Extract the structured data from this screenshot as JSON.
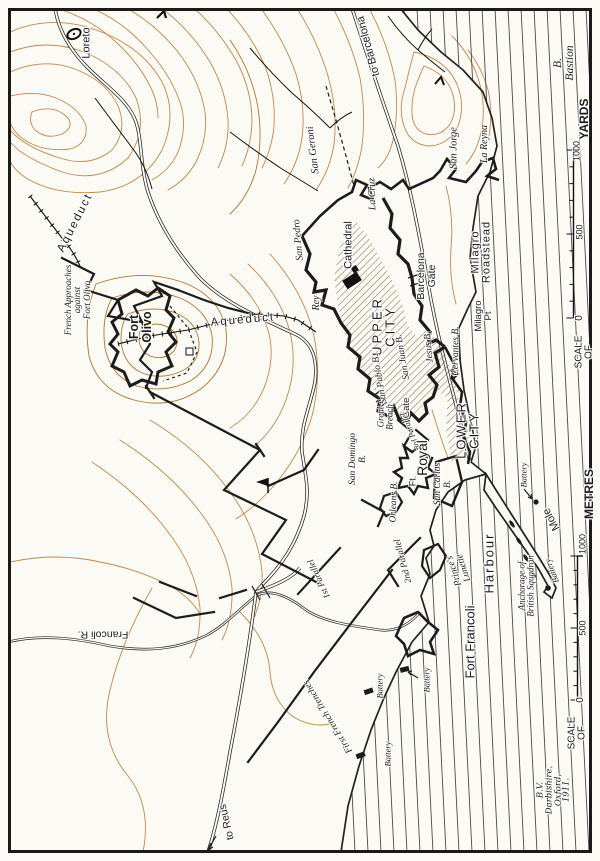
{
  "colors": {
    "paper": "#fcfaf4",
    "ink": "#1c1c1c",
    "contour": "#c4874a",
    "contour2": "#b2762f",
    "hatch": "#85704e",
    "sealine": "#4a4a4a"
  },
  "map": {
    "description_labels": "Siege map lettering (map is rotated; most text reads bottom-to-top)",
    "labels": [
      {
        "n": "loreto",
        "t": "Loreto",
        "x": 87,
        "y": 43,
        "r": -90,
        "s": 11,
        "c": "sans"
      },
      {
        "n": "to-barcelona",
        "t": "to Barcelona",
        "x": 369,
        "y": 46,
        "r": -105,
        "s": 11,
        "c": "sans"
      },
      {
        "n": "b-bastion-legend",
        "t": "B.  Bastion",
        "x": 565,
        "y": 63,
        "r": -90,
        "s": 11.5,
        "c": "it"
      },
      {
        "n": "yards-label",
        "t": "YARDS",
        "x": 584,
        "y": 119,
        "r": -90,
        "s": 12,
        "c": "sans",
        "w": 700
      },
      {
        "n": "yards-1000",
        "t": "1000",
        "x": 577,
        "y": 151,
        "r": -90,
        "s": 9,
        "c": "sans"
      },
      {
        "n": "yards-500",
        "t": "500",
        "x": 580,
        "y": 232,
        "r": -90,
        "s": 9,
        "c": "sans"
      },
      {
        "n": "yards-0",
        "t": "0",
        "x": 580,
        "y": 318,
        "r": -90,
        "s": 10,
        "c": "sans"
      },
      {
        "n": "yards-scale-of",
        "t": "SCALE OF",
        "x": 585,
        "y": 352,
        "r": -90,
        "s": 10,
        "c": "sans"
      },
      {
        "n": "metres-label",
        "t": "METRES",
        "x": 589,
        "y": 494,
        "r": -90,
        "s": 12,
        "c": "sans",
        "w": 700
      },
      {
        "n": "metres-1000",
        "t": "1000",
        "x": 583,
        "y": 544,
        "r": -90,
        "s": 9,
        "c": "sans"
      },
      {
        "n": "metres-500",
        "t": "500",
        "x": 583,
        "y": 628,
        "r": -90,
        "s": 9,
        "c": "sans"
      },
      {
        "n": "metres-0",
        "t": "0",
        "x": 581,
        "y": 700,
        "r": -90,
        "s": 10,
        "c": "sans"
      },
      {
        "n": "metres-scale-of",
        "t": "SCALE OF",
        "x": 578,
        "y": 733,
        "r": -90,
        "s": 10,
        "c": "sans"
      },
      {
        "n": "signature",
        "t": "B.V. Darbishire, Oxford, 1911.",
        "x": 554,
        "y": 790,
        "r": -90,
        "s": 8.5,
        "c": "scr"
      },
      {
        "n": "san-geroni",
        "t": "San Geroni",
        "x": 314,
        "y": 150,
        "r": -97,
        "s": 10.5,
        "c": "it"
      },
      {
        "n": "la-cruz",
        "t": "La Cruz",
        "x": 373,
        "y": 194,
        "r": -92,
        "s": 10,
        "c": "it"
      },
      {
        "n": "san-pedro",
        "t": "San Pedro",
        "x": 299,
        "y": 240,
        "r": -95,
        "s": 10,
        "c": "it"
      },
      {
        "n": "rey",
        "t": "Rey",
        "x": 317,
        "y": 303,
        "r": -90,
        "s": 10,
        "c": "it"
      },
      {
        "n": "cathedral",
        "t": "Cathedral",
        "x": 349,
        "y": 245,
        "r": -90,
        "s": 11,
        "c": "sans"
      },
      {
        "n": "san-jorge",
        "t": "San Jorge",
        "x": 455,
        "y": 148,
        "r": -90,
        "s": 10.5,
        "c": "it"
      },
      {
        "n": "la-reyna",
        "t": "La Reyna",
        "x": 485,
        "y": 144,
        "r": -90,
        "s": 10,
        "c": "it"
      },
      {
        "n": "upper-city",
        "t": "UPPER\nCITY",
        "x": 384,
        "y": 326,
        "r": -90,
        "s": 13,
        "c": "sans",
        "sp": 3
      },
      {
        "n": "barcelona-gate",
        "t": "Barcelona\nGate",
        "x": 427,
        "y": 276,
        "r": -90,
        "s": 10.5,
        "c": "sans"
      },
      {
        "n": "milagro-roadstead",
        "t": "Milagro\nRoadstead",
        "x": 482,
        "y": 252,
        "r": -90,
        "s": 11,
        "c": "sans",
        "sp": 1
      },
      {
        "n": "milagro-pt",
        "t": "Milagro\nPt",
        "x": 484,
        "y": 316,
        "r": -90,
        "s": 9.5,
        "c": "sans"
      },
      {
        "n": "cervantes-b",
        "t": "Cervantes B.",
        "x": 457,
        "y": 351,
        "r": -90,
        "s": 9.5,
        "c": "it"
      },
      {
        "n": "jesus-b",
        "t": "Jesus B.",
        "x": 430,
        "y": 347,
        "r": -96,
        "s": 9.5,
        "c": "it"
      },
      {
        "n": "san-juan-b",
        "t": "San Juan B.",
        "x": 404,
        "y": 357,
        "r": -100,
        "s": 9.5,
        "c": "it"
      },
      {
        "n": "san-pablo-b",
        "t": "San Pablo B.",
        "x": 381,
        "y": 379,
        "r": -100,
        "s": 9.5,
        "c": "it"
      },
      {
        "n": "gate-south",
        "t": "Gate",
        "x": 407,
        "y": 408,
        "r": -90,
        "s": 9.5,
        "c": "sans"
      },
      {
        "n": "great-breach",
        "t": "Great\nBreach",
        "x": 386,
        "y": 417,
        "r": -90,
        "s": 9,
        "c": "it"
      },
      {
        "n": "third-parallel",
        "t": "3rd Parallel",
        "x": 411,
        "y": 431,
        "r": -112,
        "s": 8,
        "c": "it"
      },
      {
        "n": "san-domingo-b",
        "t": "San Domingo\nB.",
        "x": 359,
        "y": 459,
        "r": -90,
        "s": 9.5,
        "c": "it"
      },
      {
        "n": "orleans-b",
        "t": "Orleans B.",
        "x": 395,
        "y": 502,
        "r": -88,
        "s": 9.5,
        "c": "it"
      },
      {
        "n": "ft-royal",
        "t": "Royal",
        "x": 422,
        "y": 458,
        "r": -90,
        "s": 14,
        "c": "sans"
      },
      {
        "n": "ft-royal-ft",
        "t": "Ft.",
        "x": 413,
        "y": 481,
        "r": -90,
        "s": 9,
        "c": "sans"
      },
      {
        "n": "san-carlos-b",
        "t": "San Carlos\nB.",
        "x": 444,
        "y": 484,
        "r": -90,
        "s": 9.5,
        "c": "it"
      },
      {
        "n": "lower-city",
        "t": "LOWER\nCITY",
        "x": 468,
        "y": 430,
        "r": -90,
        "s": 13,
        "c": "sans",
        "sp": 2
      },
      {
        "n": "princes-lunette",
        "t": "Prince's\nLunette",
        "x": 460,
        "y": 569,
        "r": -108,
        "s": 9.5,
        "c": "it"
      },
      {
        "n": "first-parallel",
        "t": "1st Parallel",
        "x": 319,
        "y": 579,
        "r": -115,
        "s": 9,
        "c": "it"
      },
      {
        "n": "second-parallel",
        "t": "2nd Parallel",
        "x": 403,
        "y": 561,
        "r": -105,
        "s": 9,
        "c": "it"
      },
      {
        "n": "first-french-trenches",
        "t": "First French Trenches",
        "x": 329,
        "y": 716,
        "r": -122,
        "s": 9.5,
        "c": "it"
      },
      {
        "n": "fort-francoli",
        "t": "Fort Francoli",
        "x": 470,
        "y": 642,
        "r": -90,
        "s": 13,
        "c": "sans"
      },
      {
        "n": "harbour",
        "t": "Harbour",
        "x": 489,
        "y": 563,
        "r": -90,
        "s": 13,
        "c": "sans",
        "sp": 2
      },
      {
        "n": "anchorage",
        "t": "Anchorage of\nBritish Squadron",
        "x": 527,
        "y": 586,
        "r": -90,
        "s": 9,
        "c": "it"
      },
      {
        "n": "mole",
        "t": "Mole",
        "x": 552,
        "y": 519,
        "r": -118,
        "s": 11,
        "c": "sans"
      },
      {
        "n": "battery-mole-north",
        "t": "Battery",
        "x": 524,
        "y": 475,
        "r": -90,
        "s": 8.5,
        "c": "it"
      },
      {
        "n": "battery-mole-south",
        "t": "Battery",
        "x": 552,
        "y": 571,
        "r": -112,
        "s": 8.5,
        "c": "it"
      },
      {
        "n": "battery-coast-west",
        "t": "Battery",
        "x": 380,
        "y": 686,
        "r": -90,
        "s": 8.5,
        "c": "it"
      },
      {
        "n": "battery-coast-east",
        "t": "Battery",
        "x": 427,
        "y": 680,
        "r": -90,
        "s": 8.5,
        "c": "it"
      },
      {
        "n": "battery-coast-south",
        "t": "Battery",
        "x": 388,
        "y": 754,
        "r": -90,
        "s": 8.5,
        "c": "it"
      },
      {
        "n": "francoli-r",
        "t": "Francoli  R.",
        "x": 103,
        "y": 634,
        "r": 180,
        "s": 10.5,
        "c": "sans"
      },
      {
        "n": "to-reus",
        "t": "to Reus",
        "x": 227,
        "y": 822,
        "r": -103,
        "s": 10.5,
        "c": "sans"
      },
      {
        "n": "fort-olivo",
        "t": "Fort\nOlivo",
        "x": 141,
        "y": 327,
        "r": -90,
        "s": 12.5,
        "c": "sans",
        "w": 700
      },
      {
        "n": "french-approaches",
        "t": "French Approaches\nagainst\nFort Olivo",
        "x": 78,
        "y": 300,
        "r": -90,
        "s": 9,
        "c": "it"
      },
      {
        "n": "aqueduct-nw",
        "t": "Aqueduct",
        "x": 76,
        "y": 223,
        "r": -63,
        "s": 11.5,
        "c": "sans",
        "sp": 2
      },
      {
        "n": "aqueduct-mid",
        "t": "Aqueduct",
        "x": 243,
        "y": 321,
        "r": -5,
        "s": 11.5,
        "c": "sans",
        "sp": 2
      }
    ],
    "scale_yards": {
      "title": "SCALE OF",
      "ticks": [
        "0",
        "500",
        "1000"
      ],
      "unit": "YARDS"
    },
    "scale_metres": {
      "title": "SCALE OF",
      "ticks": [
        "0",
        "500",
        "1000"
      ],
      "unit": "METRES"
    },
    "legend_note": "B.  Bastion"
  }
}
